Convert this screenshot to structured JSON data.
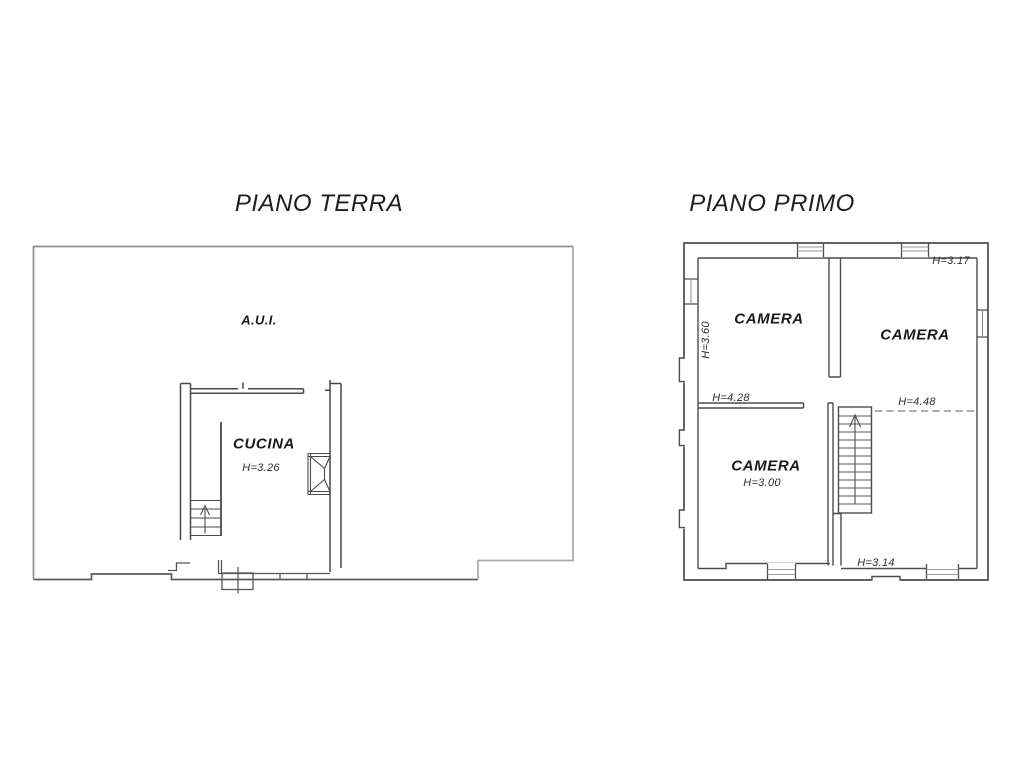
{
  "page": {
    "background_color": "#ffffff",
    "line_color_dark": "#4c4c4c",
    "line_color_light": "#9a9a9a"
  },
  "floor_plans": {
    "piano_terra": {
      "title": "PIANO TERRA",
      "rooms": {
        "aui": {
          "label": "A.U.I."
        },
        "cucina": {
          "label": "CUCINA",
          "ceiling_height": "H=3.26"
        }
      }
    },
    "piano_primo": {
      "title": "PIANO PRIMO",
      "rooms": {
        "camera_nw": {
          "label": "CAMERA",
          "ceiling_height": "H=3.60"
        },
        "camera_ne": {
          "label": "CAMERA",
          "ceiling_height": "H=3.17"
        },
        "camera_sw": {
          "label": "CAMERA",
          "ceiling_height": "H=3.00"
        }
      },
      "annotations": {
        "h_corridor_left": "H=4.28",
        "h_corridor_right": "H=4.48",
        "h_landing": "H=3.14"
      }
    }
  }
}
